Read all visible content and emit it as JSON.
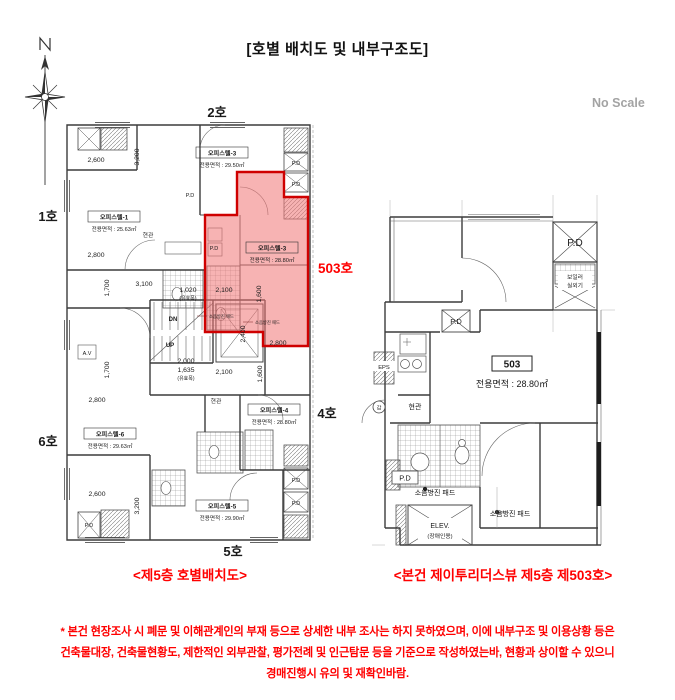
{
  "title": "[호별 배치도 및 내부구조도]",
  "scale_note": "No Scale",
  "colors": {
    "highlight_fill": "#f07474",
    "highlight_stroke": "#cf0000",
    "annotation_red": "#ff0000",
    "wall_line": "#3c3c3c"
  },
  "left_plan": {
    "caption": "<제5층  호별배치도>",
    "ho_labels": {
      "h2": "2호",
      "h1": "1호",
      "h6": "6호",
      "h4": "4호",
      "h5": "5호"
    },
    "highlight_label": "503호",
    "units": [
      {
        "name": "오피스텔-3",
        "area": "전용면적 : 29.50㎡"
      },
      {
        "name": "오피스텔-1",
        "area": "전용면적 : 25.63㎡"
      },
      {
        "name": "오피스텔-3",
        "area": "전용면적 : 28.80㎡"
      },
      {
        "name": "오피스텔-6",
        "area": "전용면적 : 29.63㎡"
      },
      {
        "name": "오피스텔-4",
        "area": "전용면적 : 28.80㎡"
      },
      {
        "name": "오피스텔-5",
        "area": "전용면적 : 29.90㎡"
      }
    ],
    "dims": [
      "2,600",
      "3,200",
      "2,800",
      "1,700",
      "3,100",
      "1,020",
      "(유효폭)",
      "2,100",
      "1,600",
      "2,400",
      "2,800",
      "2,000",
      "1,635",
      "(유효폭)",
      "2,100",
      "1,600",
      "1,700",
      "2,800",
      "2,600",
      "3,200"
    ],
    "labels": {
      "pd": "P.D",
      "av": "A.V",
      "dn": "DN",
      "up": "UP",
      "entry": "현관",
      "pad": "소음방진 패드"
    }
  },
  "right_plan": {
    "caption": "<본건 제이투리더스뷰 제5층 제503호>",
    "unit_no": "503",
    "area": "전용면적 : 28.80㎡",
    "labels": {
      "pd": "P.D",
      "boiler_line1": "보일러",
      "boiler_line2": "실외기",
      "eps": "EPS",
      "entry": "현관",
      "gap": "갑",
      "pad": "소음방진 패드",
      "elev": "ELEV.",
      "elev_sub": "(장애인용)"
    }
  },
  "footnote_lines": [
    "* 본건 현장조사 시 폐문 및 이해관계인의 부재 등으로 상세한 내부 조사는 하지 못하였으며, 이에 내부구조 및 이용상황 등은",
    "건축물대장, 건축물현황도, 제한적인 외부관찰, 평가전례 및 인근탐문 등을 기준으로 작성하였는바, 현황과 상이할 수 있으니",
    "경매진행시 유의 및 재확인바람."
  ]
}
